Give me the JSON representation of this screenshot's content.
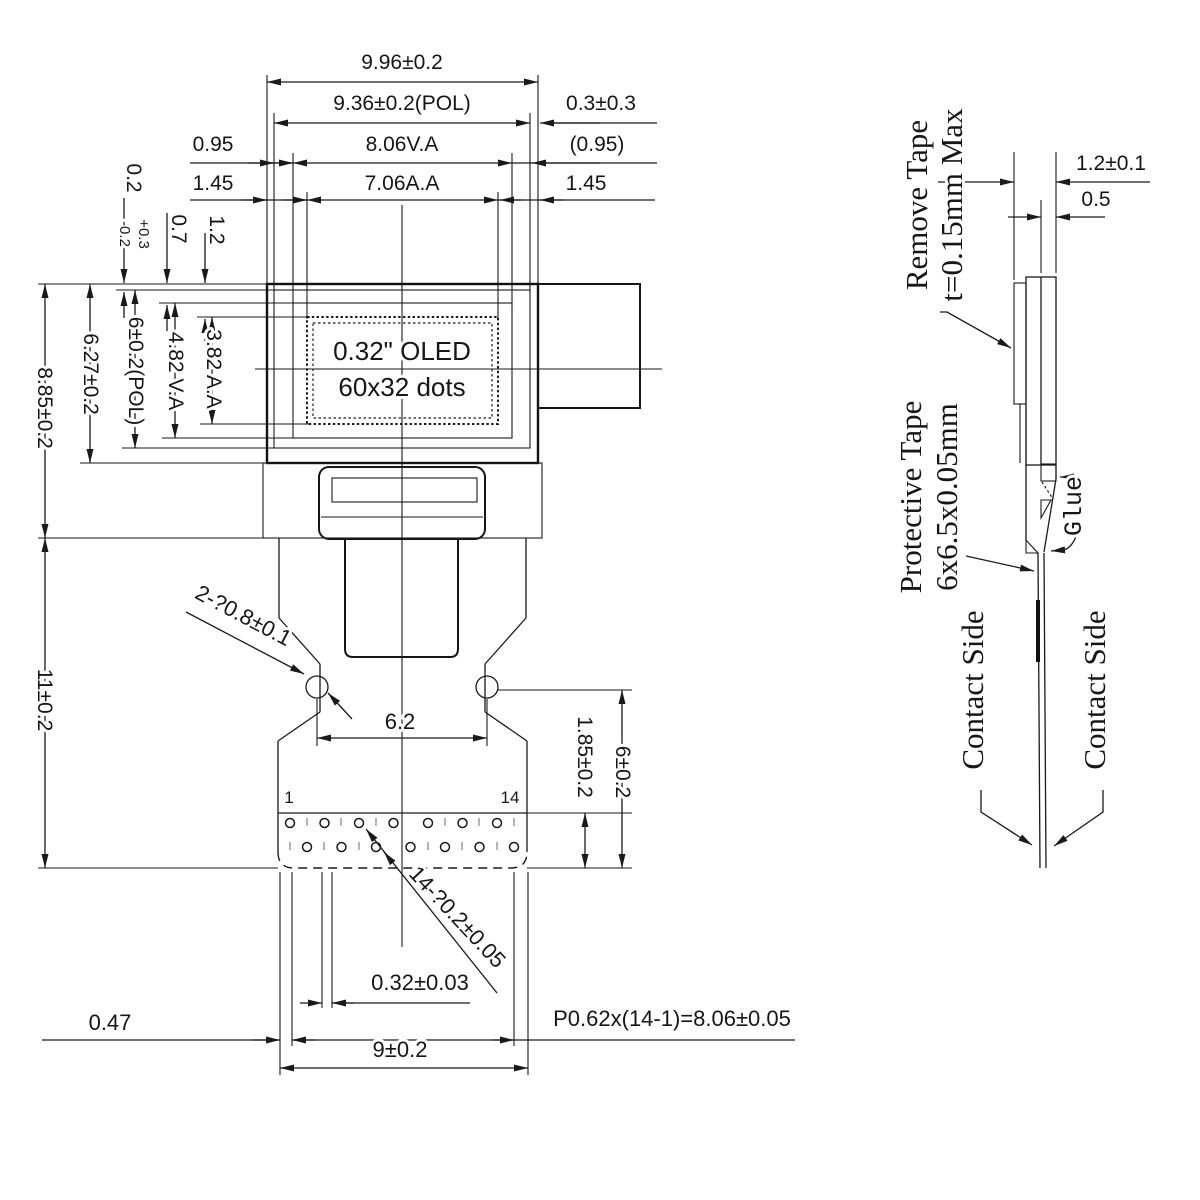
{
  "front": {
    "width_overall": "9.96±0.2",
    "width_pol": "9.36±0.2(POL)",
    "gap_right": "0.3±0.3",
    "gap_va_left": "0.95",
    "width_va": "8.06V.A",
    "gap_va_right": "(0.95)",
    "gap_aa_left": "1.45",
    "width_aa": "7.06A.A",
    "gap_aa_right": "1.45",
    "tol_base": "0.2",
    "tol_plus": "+0.3",
    "tol_minus": "-0.2",
    "offset_va_top": "0.7",
    "offset_aa_top": "1.2",
    "height_overall": "8.85±0.2",
    "height_module": "6.27±0.2",
    "height_pol": "6±0.2(POL)",
    "height_va": "4.82 V.A",
    "height_aa": "3.82 A.A",
    "height_tail": "11±0.2",
    "display_line1": "0.32\" OLED",
    "display_line2": "60x32 dots",
    "callout_holes": "2-?0.8±0.1",
    "hole_spacing": "6.2",
    "pin_depth": "1.85±0.2",
    "pin_area_height": "6±0.2",
    "pin_first": "1",
    "pin_last": "14",
    "callout_pin_holes": "14-?0.2±0.05",
    "pad_width": "0.32±0.03",
    "edge_margin": "0.47",
    "pitch_formula": "P0.62x(14-1)=8.06±0.05",
    "tail_width": "9±0.2"
  },
  "side": {
    "thickness_total": "1.2±0.1",
    "thickness_glass": "0.5",
    "remove_tape_line1": "Remove Tape",
    "remove_tape_line2": "t=0.15mm Max",
    "protective_tape_line1": "Protective Tape",
    "protective_tape_line2": "6x6.5x0.05mm",
    "glue": "Glue",
    "contact_side_left": "Contact Side",
    "contact_side_right": "Contact Side"
  },
  "colors": {
    "line": "#1a1a1a",
    "background": "#ffffff"
  }
}
